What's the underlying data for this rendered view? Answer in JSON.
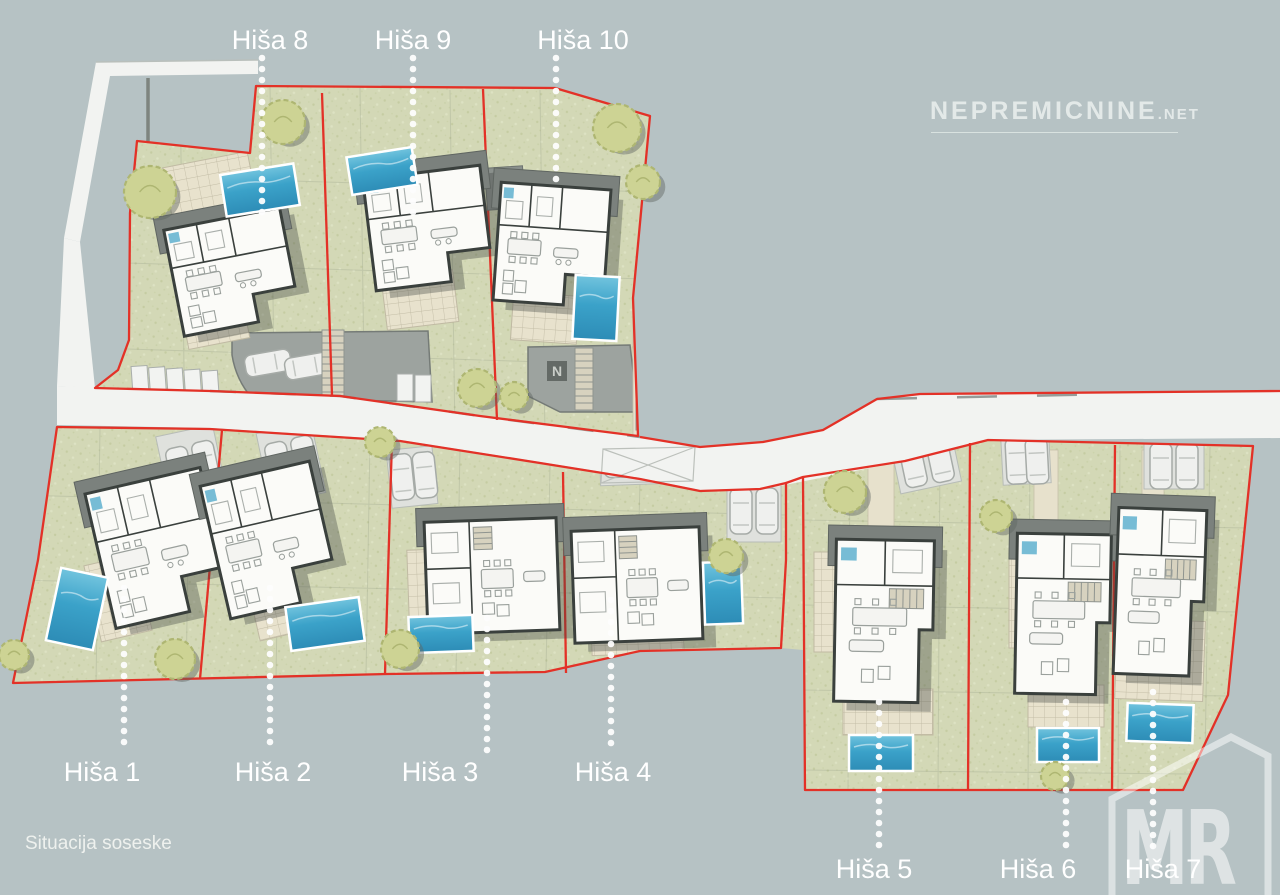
{
  "watermark": {
    "text": "NEPREMICNINE",
    "suffix": ".NET"
  },
  "caption": "Situacija soseske",
  "logo": {
    "text": "MR"
  },
  "houses": [
    {
      "id": 1,
      "label": "Hiša 1",
      "label_x": 102,
      "label_y": 772,
      "line_x": 124,
      "line_y1": 588,
      "line_y2": 752
    },
    {
      "id": 2,
      "label": "Hiša 2",
      "label_x": 273,
      "label_y": 772,
      "line_x": 270,
      "line_y1": 588,
      "line_y2": 752
    },
    {
      "id": 3,
      "label": "Hiša 3",
      "label_x": 440,
      "label_y": 772,
      "line_x": 487,
      "line_y1": 618,
      "line_y2": 752
    },
    {
      "id": 4,
      "label": "Hiša 4",
      "label_x": 613,
      "label_y": 772,
      "line_x": 611,
      "line_y1": 600,
      "line_y2": 752
    },
    {
      "id": 5,
      "label": "Hiša 5",
      "label_x": 874,
      "label_y": 869,
      "line_x": 879,
      "line_y1": 702,
      "line_y2": 850
    },
    {
      "id": 6,
      "label": "Hiša 6",
      "label_x": 1038,
      "label_y": 869,
      "line_x": 1066,
      "line_y1": 702,
      "line_y2": 850
    },
    {
      "id": 7,
      "label": "Hiša 7",
      "label_x": 1163,
      "label_y": 869,
      "line_x": 1153,
      "line_y1": 692,
      "line_y2": 850
    },
    {
      "id": 8,
      "label": "Hiša 8",
      "label_x": 270,
      "label_y": 40,
      "line_x": 262,
      "line_y1": 58,
      "line_y2": 222
    },
    {
      "id": 9,
      "label": "Hiša 9",
      "label_x": 413,
      "label_y": 40,
      "line_x": 413,
      "line_y1": 58,
      "line_y2": 218
    },
    {
      "id": 10,
      "label": "Hiša 10",
      "label_x": 583,
      "label_y": 40,
      "line_x": 556,
      "line_y1": 58,
      "line_y2": 183
    }
  ],
  "colors": {
    "background": "#b6c2c4",
    "grass": "#d3d8b6",
    "road": "#f2f3f1",
    "boundary_red": "#e33127",
    "pool_blue": "#3fa6cc",
    "tree_olive": "#cdd394",
    "roof_gray": "#7b817d",
    "label_text": "#ffffff"
  }
}
